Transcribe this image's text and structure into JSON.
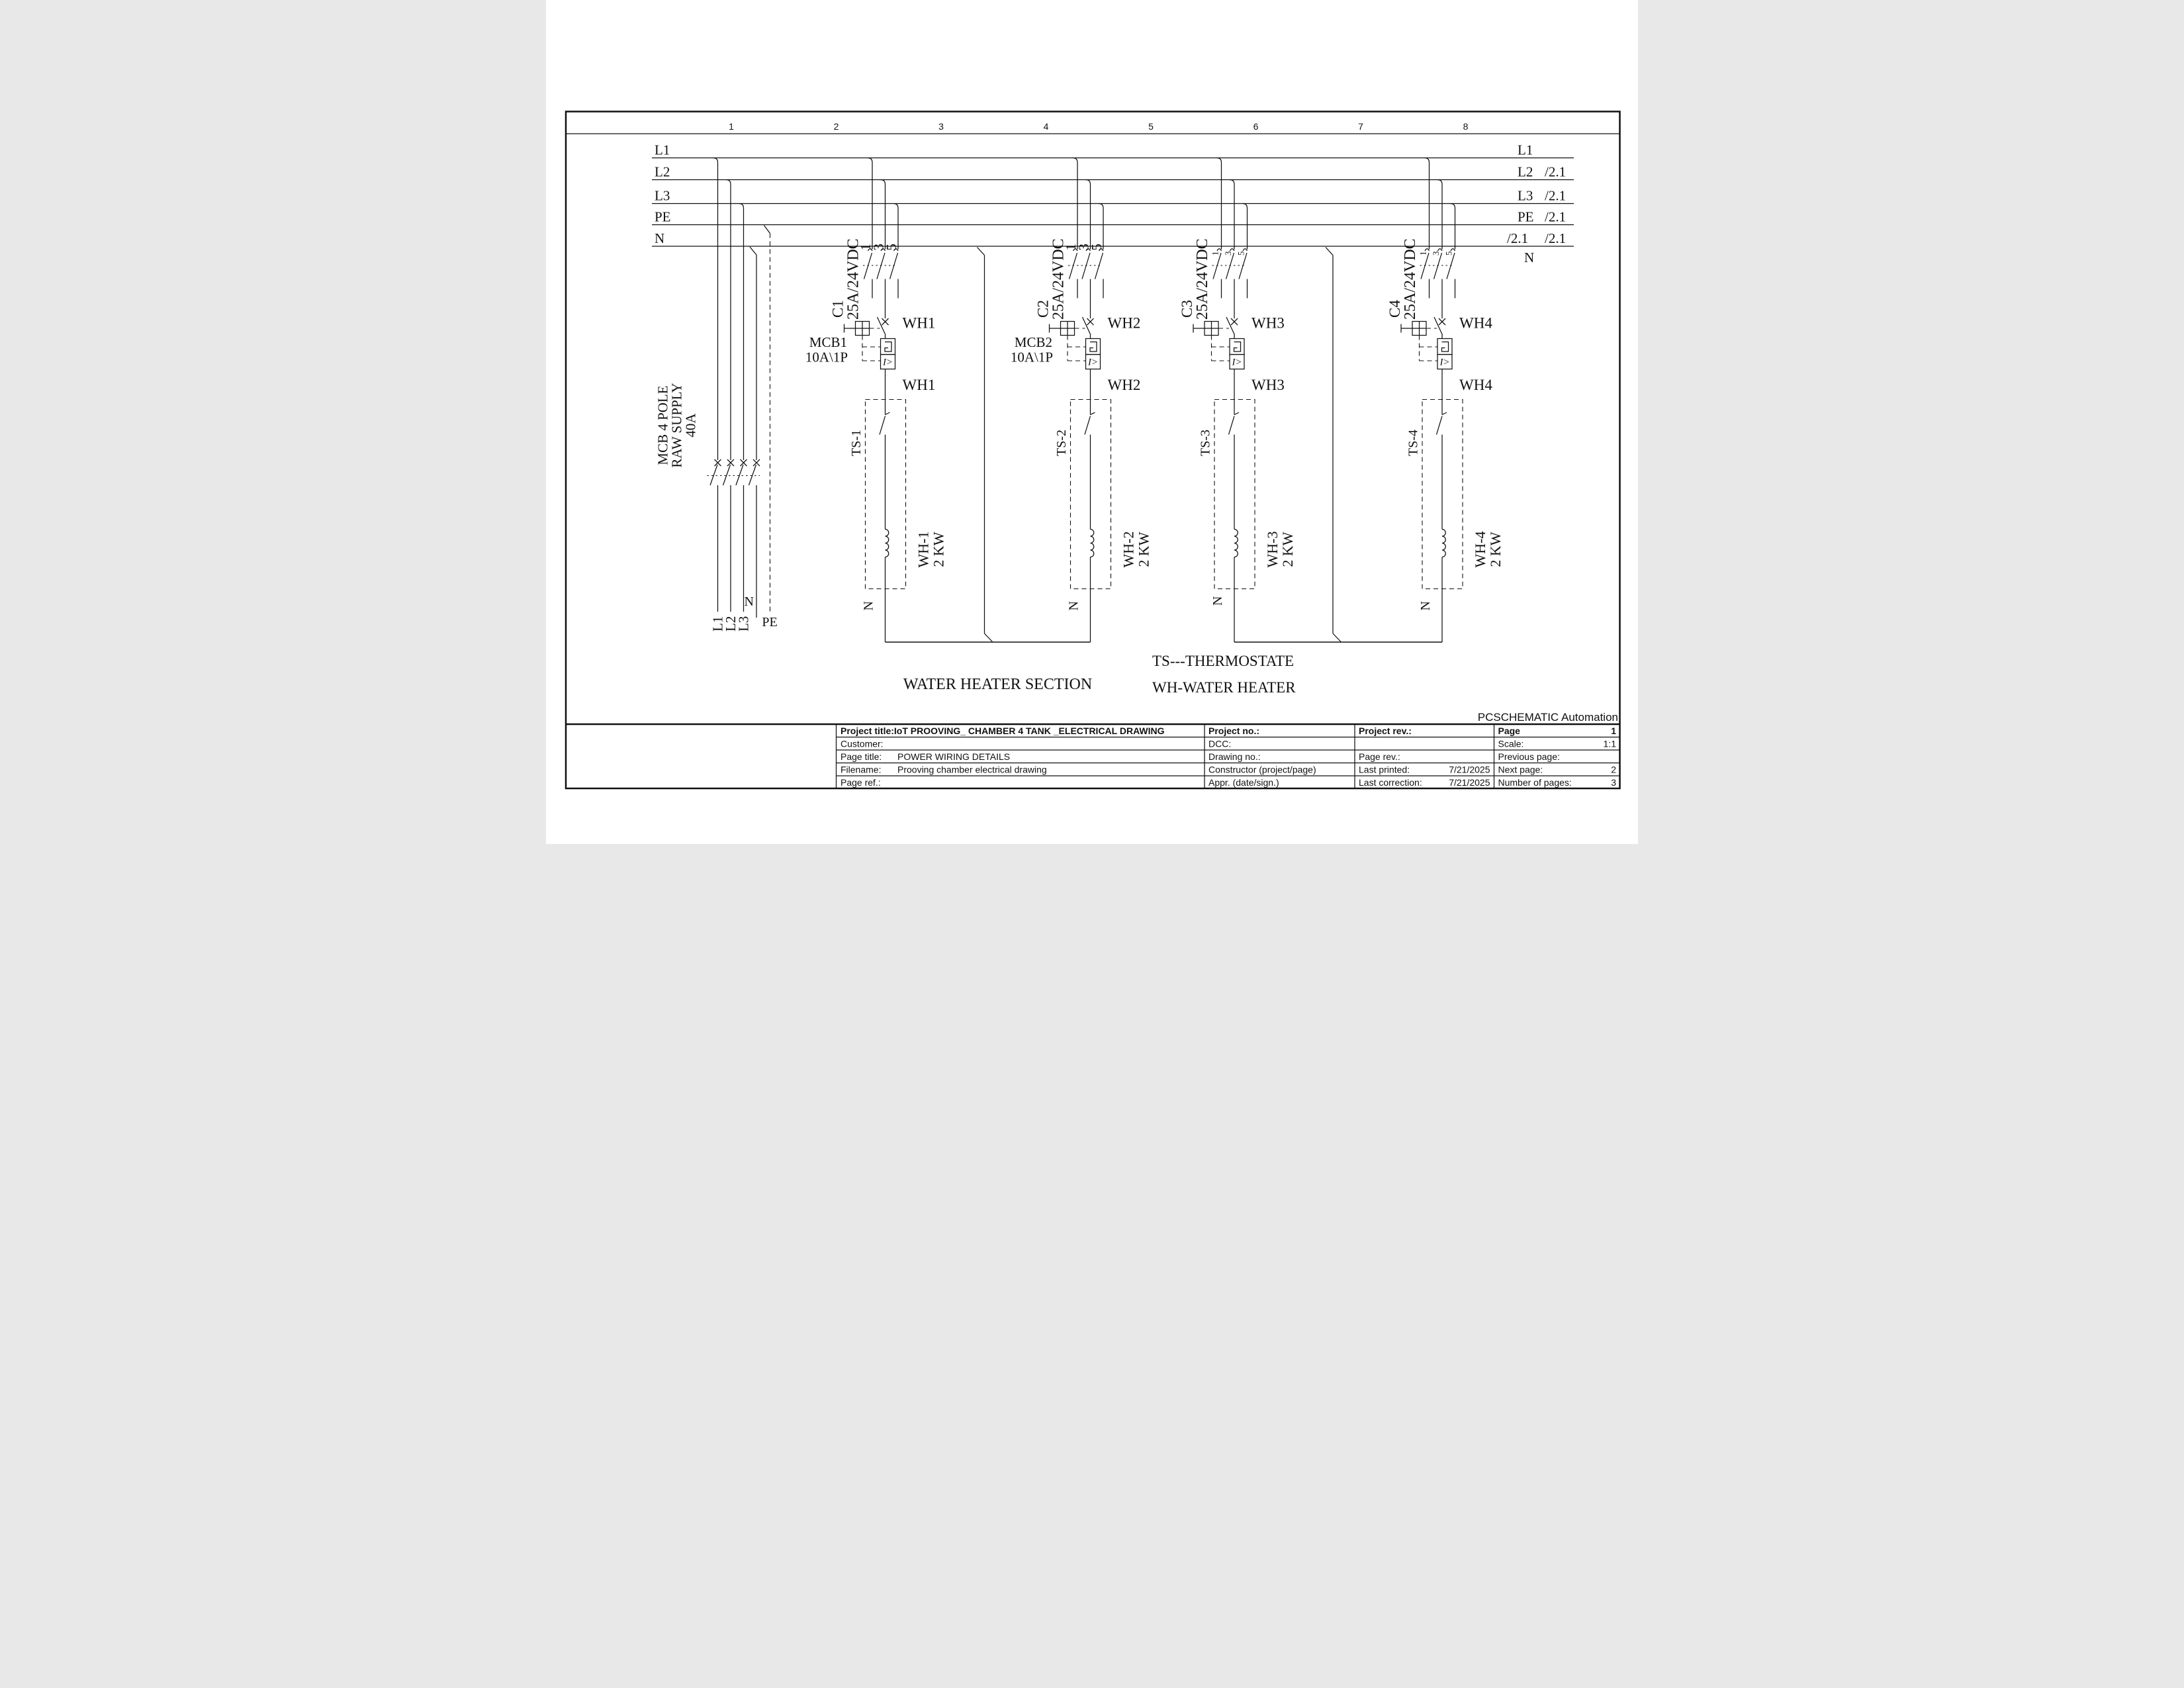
{
  "frame": {
    "columns": [
      "1",
      "2",
      "3",
      "4",
      "5",
      "6",
      "7",
      "8"
    ]
  },
  "buses": {
    "left_labels": [
      "L1",
      "L2",
      "L3",
      "PE",
      "N"
    ],
    "right": {
      "l1": {
        "label": "L1",
        "ref": ""
      },
      "l2": {
        "label": "L2",
        "ref": "/2.1"
      },
      "l3": {
        "label": "L3",
        "ref": "/2.1"
      },
      "pe": {
        "label": "PE",
        "ref": "/2.1"
      },
      "n": {
        "label": "N",
        "ref_a": "/2.1",
        "ref_b": "/2.1"
      }
    }
  },
  "supply": {
    "label_lines": [
      "MCB 4 POLE",
      "RAW SUPPLY",
      "40A"
    ],
    "bottom": {
      "l1": "L1",
      "l2": "L2",
      "l3": "L3",
      "n": "N",
      "pe": "PE"
    }
  },
  "symbols": {
    "trip": "I>"
  },
  "branches": [
    {
      "contactor": "C1",
      "rating": "25A/24VDC",
      "poles": [
        "1",
        "3",
        "5"
      ],
      "device_top": "WH1",
      "device_mid": "WH1",
      "mcb_name": "MCB1",
      "mcb_rating": "10A\\1P",
      "thermostat": "TS-1",
      "heater": "WH-1",
      "power": "2 KW",
      "neutral": "N"
    },
    {
      "contactor": "C2",
      "rating": "25A/24VDC",
      "poles": [
        "1",
        "3",
        "5"
      ],
      "device_top": "WH2",
      "device_mid": "WH2",
      "mcb_name": "MCB2",
      "mcb_rating": "10A\\1P",
      "thermostat": "TS-2",
      "heater": "WH-2",
      "power": "2 KW",
      "neutral": "N"
    },
    {
      "contactor": "C3",
      "rating": "25A/24VDC",
      "poles": [
        "1",
        "3",
        "5"
      ],
      "device_top": "WH3",
      "device_mid": "WH3",
      "thermostat": "TS-3",
      "heater": "WH-3",
      "power": "2 KW",
      "neutral": "N"
    },
    {
      "contactor": "C4",
      "rating": "25A/24VDC",
      "poles": [
        "1",
        "3",
        "5"
      ],
      "device_top": "WH4",
      "device_mid": "WH4",
      "thermostat": "TS-4",
      "heater": "WH-4",
      "power": "2 KW",
      "neutral": "N"
    }
  ],
  "legend": {
    "section": "WATER HEATER SECTION",
    "ts": "TS---THERMOSTATE",
    "wh": "WH-WATER HEATER"
  },
  "brand": "PCSCHEMATIC Automation",
  "titleblock": {
    "project_title": "Project title:IoT PROOVING_ CHAMBER 4 TANK _ELECTRICAL DRAWING",
    "customer": "Customer:",
    "page_title_label": "Page title:",
    "page_title": "POWER WIRING DETAILS",
    "filename_label": "Filename:",
    "filename": "Prooving chamber electrical drawing",
    "page_ref": "Page ref.:",
    "project_no": "Project no.:",
    "dcc": "DCC:",
    "drawing_no": "Drawing no.:",
    "constructor": "Constructor (project/page)",
    "appr": "Appr. (date/sign.)",
    "project_rev": "Project rev.:",
    "page_rev": "Page rev.:",
    "last_printed_label": "Last printed:",
    "last_printed": "7/21/2025",
    "last_correction_label": "Last correction:",
    "last_correction": "7/21/2025",
    "page_label": "Page",
    "page": "1",
    "scale_label": "Scale:",
    "scale": "1:1",
    "prev_label": "Previous page:",
    "next_label": "Next page:",
    "next": "2",
    "pages_label": "Number of pages:",
    "pages": "3"
  }
}
